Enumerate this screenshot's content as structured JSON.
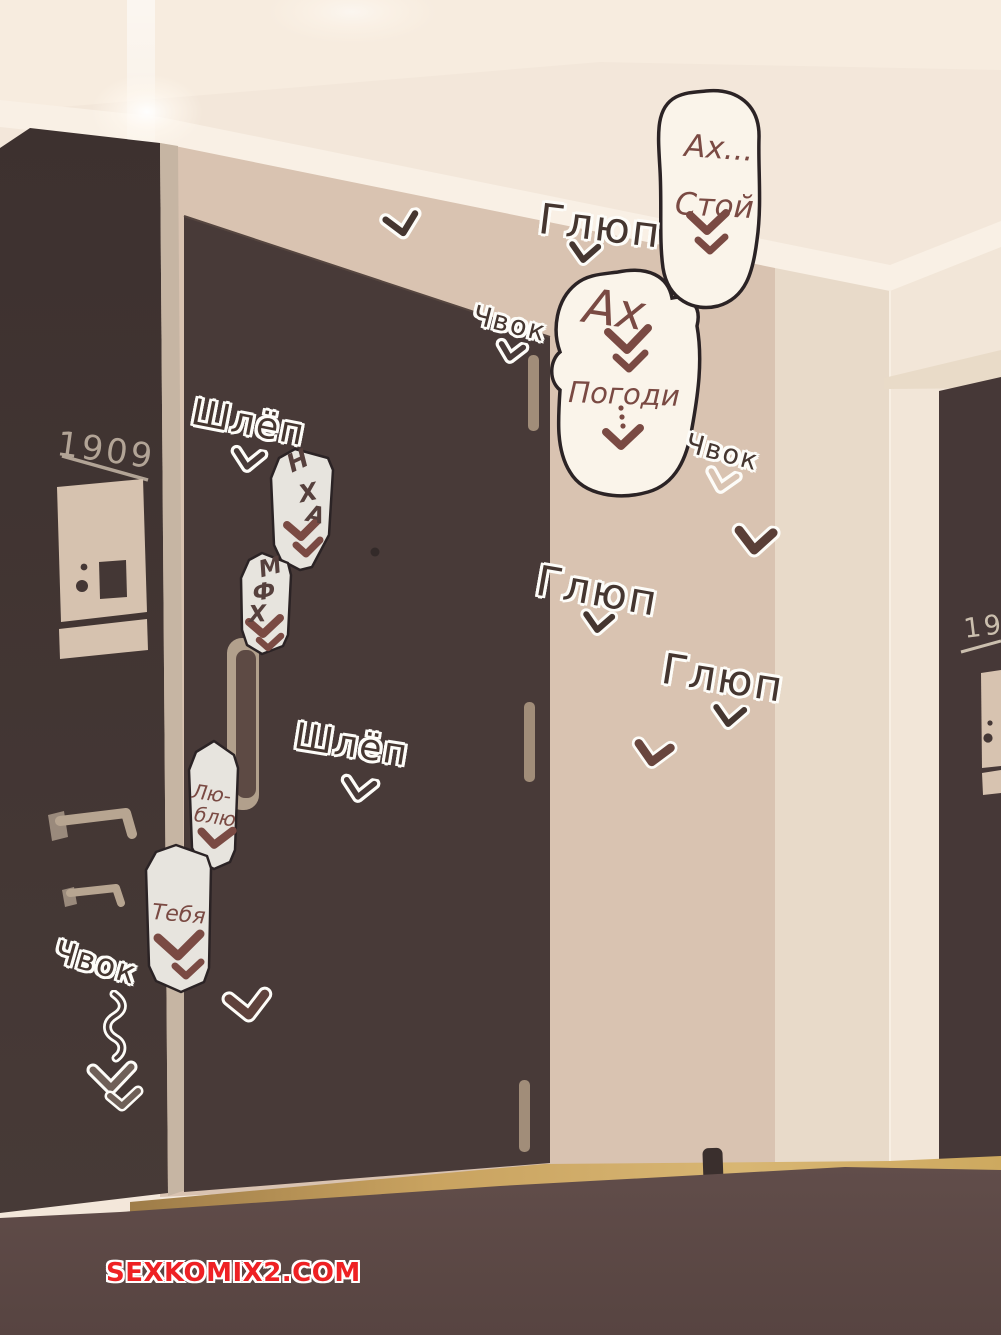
{
  "scene": {
    "watermark": "SEXKOMIX2.COM",
    "left_door_number": "1909",
    "right_door_number": "19"
  },
  "bubbles": {
    "ah_stoy": {
      "line1": "Ах...",
      "line2": "Стой"
    },
    "ah_pogodi": {
      "line1": "Ах",
      "line2": "Погоди"
    },
    "nha": {
      "l1": "Н",
      "l2": "Х",
      "l3": "А"
    },
    "mfh": {
      "l1": "М",
      "l2": "Ф",
      "l3": "Х"
    },
    "lyublyu": {
      "line1": "Лю-",
      "line2": "блю"
    },
    "tebya": {
      "line1": "Тебя"
    }
  },
  "sfx": {
    "glyup_top": "Глюп",
    "chvok_door_top": "Чвок",
    "shlyop_top": "Шлёп",
    "chvok_wall_right": "Чвок",
    "glyup_mid": "Глюп",
    "glyup_right": "Глюп",
    "shlyop_mid": "Шлёп",
    "chvok_bottom": "Чвок"
  },
  "icons": {
    "chevron_down": "hand-drawn double-stroke v chevron",
    "squiggle_arrow": "wavy line ending in double chevron"
  },
  "colors": {
    "dark_wall": "#423532",
    "door": "#483a38",
    "beige_wall": "#d9c3b1",
    "light_wall": "#f2e6d8",
    "ceiling": "#f3e7da",
    "floor_wood": "#c9a567",
    "foreground": "#5b4744",
    "bubble_fill": "#faf4ea",
    "small_bubble_fill": "#e7e4de",
    "ink_outline": "#2b2325",
    "accent_text": "#7a4a43",
    "watermark_red": "#ee2124"
  }
}
